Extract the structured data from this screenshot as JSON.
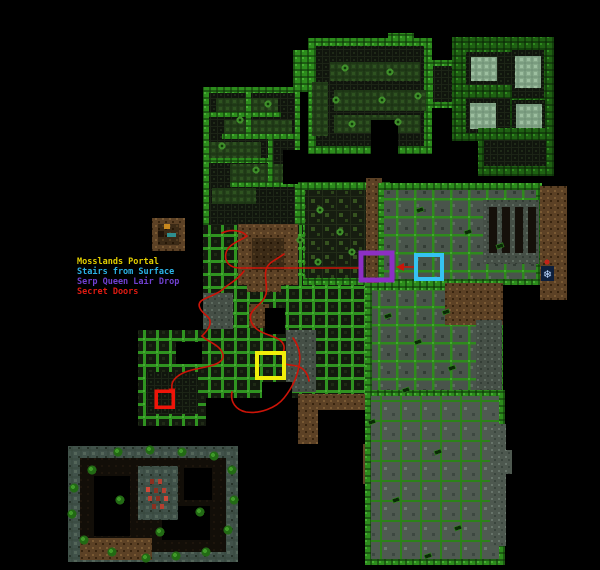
{
  "canvas": {
    "w": 600,
    "h": 570,
    "bg": "#000000"
  },
  "legend": {
    "items": [
      {
        "label": "Mosslands Portal",
        "color": "#e3cf00"
      },
      {
        "label": "Stairs from Surface",
        "color": "#2bb3e6"
      },
      {
        "label": "Serp Queen Lair Drop",
        "color": "#7040d0"
      },
      {
        "label": "Secret Doors",
        "color": "#e01b12"
      }
    ]
  },
  "markers": [
    {
      "name": "serp-queen-lair-drop-marker",
      "x": 361,
      "y": 253,
      "w": 31,
      "h": 27,
      "color": "#8c2fc4",
      "stroke": 5
    },
    {
      "name": "stairs-from-surface-marker",
      "x": 416,
      "y": 255,
      "w": 26,
      "h": 24,
      "color": "#35c3f2",
      "stroke": 4
    },
    {
      "name": "mosslands-portal-marker",
      "x": 257,
      "y": 353,
      "w": 27,
      "h": 25,
      "color": "#f2ee0a",
      "stroke": 4
    },
    {
      "name": "secret-door-marker",
      "x": 156,
      "y": 391,
      "w": 17,
      "h": 16,
      "color": "#ee1509",
      "stroke": 3.5
    }
  ],
  "red_paths": [
    "M416,267 L399,267",
    "M361,268 L240,268 C230,268 224,262 226,253 C228,244 240,241 247,236 C242,230 230,229 222,233",
    "M244,271 C238,280 228,284 222,290 C214,296 206,297 201,301 C196,306 202,312 207,316 C214,322 208,330 202,336 C208,342 218,344 222,352 C226,360 218,364 210,366 C198,369 186,370 178,376 C170,382 172,387 172,391",
    "M284,254 C276,260 268,262 266,270 C264,278 268,286 266,294 C264,302 256,306 252,312 C248,318 252,326 258,330 C265,335 276,336 281,341 C286,346 284,351 282,355",
    "M293,338 C299,346 301,356 299,366 C297,378 292,388 284,398 C276,408 260,414 246,412 C236,410 230,402 232,392",
    "M284,364 L297,366 C304,368 308,374 309,381"
  ],
  "arrows": [
    {
      "name": "arrow-to-serp-drop",
      "points": "396,267 404,263 404,271"
    },
    {
      "name": "arrow-to-secret-door",
      "points": "172,395 168.5,388.5 175.5,388.5"
    }
  ],
  "map": {
    "regions": [
      [
        293,
        50,
        22,
        42,
        "wall"
      ],
      [
        203,
        87,
        97,
        143,
        "wall"
      ],
      [
        209,
        93,
        86,
        132,
        "fdark"
      ],
      [
        216,
        98,
        62,
        16,
        "froom"
      ],
      [
        224,
        120,
        68,
        16,
        "froom"
      ],
      [
        209,
        142,
        52,
        18,
        "froom"
      ],
      [
        230,
        164,
        62,
        20,
        "froom"
      ],
      [
        212,
        188,
        44,
        16,
        "froom"
      ],
      [
        209,
        112,
        72,
        5,
        "wall"
      ],
      [
        222,
        134,
        73,
        5,
        "wall"
      ],
      [
        209,
        158,
        60,
        5,
        "wall"
      ],
      [
        230,
        182,
        65,
        5,
        "wall"
      ],
      [
        246,
        93,
        5,
        42,
        "wall"
      ],
      [
        268,
        138,
        5,
        44,
        "wall"
      ],
      [
        283,
        150,
        17,
        34,
        "black"
      ],
      [
        308,
        38,
        124,
        116,
        "wall"
      ],
      [
        388,
        33,
        26,
        8,
        "wall"
      ],
      [
        316,
        46,
        108,
        100,
        "fdark"
      ],
      [
        330,
        62,
        90,
        19,
        "froom"
      ],
      [
        334,
        90,
        92,
        21,
        "froom"
      ],
      [
        334,
        115,
        86,
        18,
        "froom"
      ],
      [
        312,
        82,
        16,
        54,
        "froom"
      ],
      [
        371,
        120,
        27,
        34,
        "black"
      ],
      [
        428,
        60,
        34,
        48,
        "wall"
      ],
      [
        433,
        66,
        24,
        36,
        "fdark"
      ],
      [
        452,
        37,
        102,
        104,
        "wallD"
      ],
      [
        466,
        52,
        46,
        33,
        "fdark"
      ],
      [
        471,
        57,
        26,
        24,
        "fmossL"
      ],
      [
        512,
        50,
        32,
        48,
        "fdark"
      ],
      [
        515,
        56,
        26,
        32,
        "fmossL"
      ],
      [
        466,
        98,
        44,
        35,
        "fdark"
      ],
      [
        470,
        103,
        26,
        26,
        "fmossL"
      ],
      [
        512,
        100,
        33,
        33,
        "fdark"
      ],
      [
        516,
        104,
        26,
        26,
        "fmossL"
      ],
      [
        478,
        128,
        76,
        48,
        "wallD"
      ],
      [
        484,
        140,
        62,
        26,
        "fdark"
      ],
      [
        298,
        182,
        92,
        103,
        "wall"
      ],
      [
        305,
        190,
        78,
        88,
        "fmoss"
      ],
      [
        366,
        178,
        16,
        108,
        "dirt"
      ],
      [
        378,
        183,
        164,
        102,
        "wall"
      ],
      [
        384,
        190,
        152,
        89,
        "hmaze"
      ],
      [
        483,
        200,
        56,
        64,
        "fgray"
      ],
      [
        489,
        207,
        8,
        46,
        "pillar"
      ],
      [
        502,
        207,
        8,
        46,
        "pillar"
      ],
      [
        515,
        207,
        8,
        46,
        "pillar"
      ],
      [
        528,
        207,
        8,
        46,
        "pillar"
      ],
      [
        540,
        186,
        27,
        114,
        "dirt"
      ],
      [
        203,
        225,
        100,
        62,
        "cmaze"
      ],
      [
        238,
        224,
        60,
        62,
        "dirt"
      ],
      [
        252,
        238,
        32,
        32,
        "dirtD"
      ],
      [
        152,
        218,
        33,
        33,
        "dirt"
      ],
      [
        158,
        224,
        21,
        21,
        "dirtD"
      ],
      [
        164,
        224,
        6,
        5,
        "#c8881e"
      ],
      [
        167,
        233,
        9,
        4,
        "#2e8f8f"
      ],
      [
        158,
        231,
        6,
        6,
        "#201409"
      ],
      [
        203,
        285,
        164,
        113,
        "cmaze"
      ],
      [
        138,
        330,
        68,
        96,
        "cmaze"
      ],
      [
        286,
        330,
        30,
        62,
        "fgray"
      ],
      [
        203,
        293,
        30,
        36,
        "fgray"
      ],
      [
        146,
        372,
        52,
        42,
        "fdark"
      ],
      [
        247,
        276,
        34,
        16,
        "dirt"
      ],
      [
        249,
        304,
        20,
        24,
        "dirt"
      ],
      [
        265,
        308,
        20,
        26,
        "black"
      ],
      [
        176,
        342,
        26,
        22,
        "black"
      ],
      [
        262,
        382,
        30,
        28,
        "black"
      ],
      [
        298,
        394,
        22,
        50,
        "dirt"
      ],
      [
        306,
        394,
        62,
        16,
        "dirt"
      ],
      [
        363,
        394,
        14,
        90,
        "dirt"
      ],
      [
        318,
        410,
        48,
        34,
        "black"
      ],
      [
        365,
        283,
        138,
        112,
        "wall"
      ],
      [
        372,
        290,
        124,
        100,
        "hmaze"
      ],
      [
        445,
        283,
        58,
        42,
        "dirt"
      ],
      [
        476,
        320,
        26,
        76,
        "fgray"
      ],
      [
        365,
        390,
        140,
        175,
        "wall"
      ],
      [
        371,
        396,
        128,
        163,
        "smaze"
      ],
      [
        490,
        424,
        16,
        122,
        "fslate"
      ],
      [
        503,
        450,
        9,
        24,
        "fslate"
      ],
      [
        68,
        446,
        170,
        116,
        "ring"
      ],
      [
        80,
        458,
        146,
        94,
        "fdarkB"
      ],
      [
        94,
        476,
        36,
        60,
        "black"
      ],
      [
        184,
        468,
        28,
        32,
        "black"
      ],
      [
        162,
        506,
        48,
        34,
        "black"
      ],
      [
        138,
        466,
        40,
        54,
        "ring"
      ],
      [
        80,
        538,
        72,
        22,
        "dirt"
      ]
    ],
    "moss_dots": [
      [
        345,
        68
      ],
      [
        390,
        72
      ],
      [
        336,
        100
      ],
      [
        382,
        100
      ],
      [
        418,
        96
      ],
      [
        352,
        124
      ],
      [
        398,
        122
      ],
      [
        268,
        104
      ],
      [
        240,
        120
      ],
      [
        222,
        146
      ],
      [
        256,
        170
      ],
      [
        320,
        210
      ],
      [
        340,
        232
      ],
      [
        352,
        252
      ],
      [
        318,
        262
      ],
      [
        300,
        240
      ]
    ],
    "door_gems": [
      [
        388,
        316
      ],
      [
        418,
        342
      ],
      [
        452,
        368
      ],
      [
        406,
        390
      ],
      [
        372,
        422
      ],
      [
        438,
        452
      ],
      [
        396,
        500
      ],
      [
        458,
        528
      ],
      [
        428,
        556
      ],
      [
        420,
        210
      ],
      [
        468,
        232
      ],
      [
        500,
        246
      ],
      [
        446,
        312
      ]
    ],
    "bushes": [
      [
        92,
        470
      ],
      [
        118,
        452
      ],
      [
        150,
        450
      ],
      [
        182,
        452
      ],
      [
        214,
        456
      ],
      [
        232,
        470
      ],
      [
        234,
        500
      ],
      [
        228,
        530
      ],
      [
        206,
        552
      ],
      [
        176,
        556
      ],
      [
        146,
        558
      ],
      [
        112,
        552
      ],
      [
        84,
        540
      ],
      [
        72,
        514
      ],
      [
        74,
        488
      ],
      [
        120,
        500
      ],
      [
        160,
        532
      ],
      [
        200,
        512
      ]
    ],
    "runes": [
      [
        150,
        479,
        "#8a3020"
      ],
      [
        158,
        479,
        "#b54030"
      ],
      [
        146,
        487,
        "#d04838"
      ],
      [
        154,
        488,
        "#8a3020"
      ],
      [
        162,
        488,
        "#b54030"
      ],
      [
        148,
        496,
        "#b54030"
      ],
      [
        156,
        496,
        "#8a3020"
      ],
      [
        164,
        496,
        "#d04838"
      ],
      [
        152,
        504,
        "#8a3020"
      ],
      [
        160,
        504,
        "#b54030"
      ]
    ]
  },
  "icons": {
    "snowflake": {
      "glyph": "❄",
      "x": 541,
      "y": 266,
      "w": 13,
      "h": 15,
      "tile": "#0d1f3c",
      "color": "#bcd8ff"
    },
    "red_dot": {
      "cx": 547,
      "cy": 262,
      "r": 2.5,
      "color": "#c42218"
    }
  },
  "path_style": {
    "color": "#cc1408",
    "width": 1.6
  }
}
